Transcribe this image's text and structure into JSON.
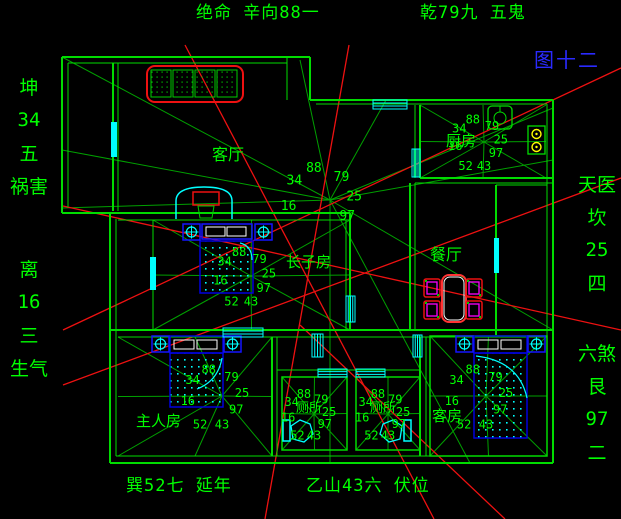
{
  "figure_label": "图十二",
  "titles": {
    "top_left": "绝命 辛向88一",
    "top_right": "乾79九 五鬼",
    "bottom_left": "巽52七 延年",
    "bottom_center": "乙山43六 伏位"
  },
  "side_labels": {
    "left_upper": [
      "坤",
      "34",
      "五",
      "祸害"
    ],
    "left_lower": [
      "离",
      "16",
      "三",
      "生气"
    ],
    "right_upper": [
      "天医",
      "坎",
      "25",
      "四"
    ],
    "right_lower": [
      "六煞",
      "艮",
      "97",
      "二"
    ]
  },
  "house_star_numbers": [
    "88",
    "79",
    "25",
    "97",
    "16",
    "34"
  ],
  "rooms": [
    {
      "name": "living-room",
      "label": "客厅"
    },
    {
      "name": "kitchen",
      "label": "厨房",
      "star_numbers": [
        "88",
        "79",
        "25",
        "97",
        "43",
        "52",
        "16",
        "34"
      ]
    },
    {
      "name": "dining-room",
      "label": "餐厅"
    },
    {
      "name": "eldest-son-room",
      "label": "长子房",
      "star_numbers": [
        "88",
        "79",
        "25",
        "97",
        "43",
        "52",
        "16",
        "34"
      ]
    },
    {
      "name": "master-bedroom",
      "label": "主人房",
      "star_numbers": [
        "88",
        "79",
        "25",
        "97",
        "43",
        "52",
        "16",
        "34"
      ]
    },
    {
      "name": "bathroom-1",
      "label": "厕所",
      "star_numbers": [
        "88",
        "79",
        "25",
        "97",
        "43",
        "52",
        "16",
        "34"
      ]
    },
    {
      "name": "bathroom-2",
      "label": "厕所",
      "star_numbers": [
        "88",
        "79",
        "25",
        "97",
        "43",
        "52",
        "16",
        "34"
      ]
    },
    {
      "name": "guest-room",
      "label": "客房",
      "star_numbers": [
        "88",
        "79",
        "25",
        "97",
        "43",
        "52",
        "16",
        "34"
      ]
    }
  ],
  "colors": {
    "background": "#000000",
    "wall_green": "#00DC00",
    "ray_green": "#00A000",
    "text_green": "#00FF00",
    "red": "#EE1111",
    "cyan": "#00FFFF",
    "blue": "#1414FF",
    "bed_blue": "#0000DD",
    "yellow": "#FFFF00",
    "magenta": "#FF00FF",
    "white": "#FFFFFF",
    "figure_label_blue": "#2A2AFF"
  }
}
